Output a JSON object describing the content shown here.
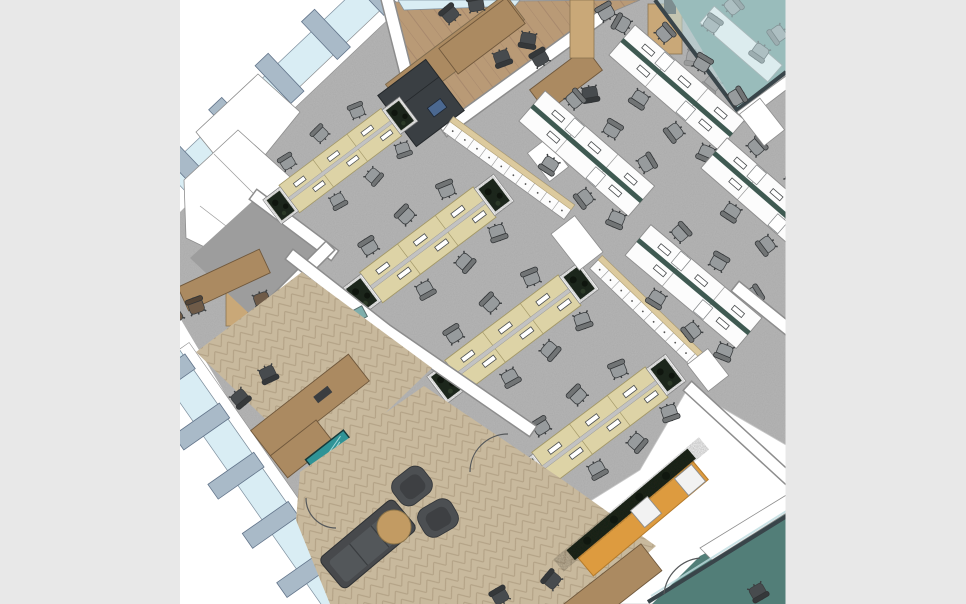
{
  "app": {
    "type": "3D office floor-plan rendering",
    "view": "isometric overhead, model rotated ~40 degrees",
    "visible_text": "none"
  },
  "viewport": {
    "width": 966,
    "height": 604,
    "canvas_left": 180,
    "canvas_right": 786
  },
  "colors": {
    "margin": "#e8e8e8",
    "canvas": "#ffffff",
    "carpet": "#b6b6b6",
    "wallStroke": "#8d8d8d",
    "glassBlue": "#d9edf4",
    "glassTealLight": "#bfdde0",
    "mullion": "#a9bac8",
    "mullionEdge": "#62748a",
    "benchTop": "#ddd3a6",
    "benchEdge": "#a39868",
    "spineSilver": "#c2c2c2",
    "spineTeal": "#3f5a52",
    "lockerTop": "#dcca9e",
    "plant": "#1f2a1d",
    "chairGray": "#979b9d",
    "chairDark": "#474b4e",
    "chairBrown": "#6f5b48",
    "woodFloor": "#b99a76",
    "herringbone": "#c8b99d",
    "herringLine": "#b3a286",
    "boothFloor": "#9d9d9d",
    "tableWood": "#ab8a61",
    "wardrobe": "#c9a878",
    "media": "#3a3f43",
    "screenBlue": "#4b6890",
    "tvTeal": "#2f9396",
    "orange": "#dd9b3f",
    "orangeEdge": "#b47a2a",
    "tealFloor": "#6a968f",
    "tealRoom": "#527e78",
    "sofa": "#47494c",
    "ottoman": "#c29b63",
    "frame": "#39454a"
  },
  "scene": {
    "facades": [
      {
        "name": "north-west window wall",
        "mullions": 5,
        "glazing": "light blue"
      },
      {
        "name": "south-west window wall",
        "mullions": 5,
        "glazing": "light blue"
      }
    ],
    "zones": [
      {
        "name": "open-plan-benching",
        "rows": 4,
        "seats_per_row": 6,
        "desk_finish": "light oak",
        "chairs": "gray task chairs",
        "planters_at_row_ends": true
      },
      {
        "name": "open-plan-white-desks",
        "rows": 4,
        "desk_finish": "white",
        "divider_spine": "dark teal",
        "chairs": "gray task chairs"
      },
      {
        "name": "glass-meeting-room",
        "floor": "teal carpet",
        "table": "white",
        "glass_walls": true,
        "chairs": 4
      },
      {
        "name": "break-room",
        "floor": "timber planks",
        "tables": 2,
        "chairs": "dark",
        "counter": "timber with sink",
        "media_wall": "dark joinery with screen",
        "tall_cabinets": 2
      },
      {
        "name": "meeting-booth",
        "table": "timber",
        "chairs": "brown",
        "floor": "gray"
      },
      {
        "name": "private-office",
        "desk": "timber L-desk",
        "guest_chairs": 2,
        "task_chair": 1,
        "floor": "herringbone timber"
      },
      {
        "name": "reception",
        "credenza": "white",
        "screen": "teal",
        "floor": "herringbone timber"
      },
      {
        "name": "lounge",
        "sofa": "charcoal",
        "armchairs": 2,
        "ottoman": "round tan",
        "coffee_table": "timber",
        "floor": "herringbone timber"
      },
      {
        "name": "teal-room",
        "floor": "teal carpet",
        "glass_partition": true,
        "door_swing": true,
        "chairs": 1
      }
    ],
    "storage": {
      "locker_runs": 2,
      "front_finish": "white",
      "top_finish": "oak",
      "columns": "white"
    },
    "banquette": {
      "color": "orange",
      "planter_hedge": "dark foliage",
      "white_cube_stools": 2
    },
    "door_swing_arcs": 4
  }
}
